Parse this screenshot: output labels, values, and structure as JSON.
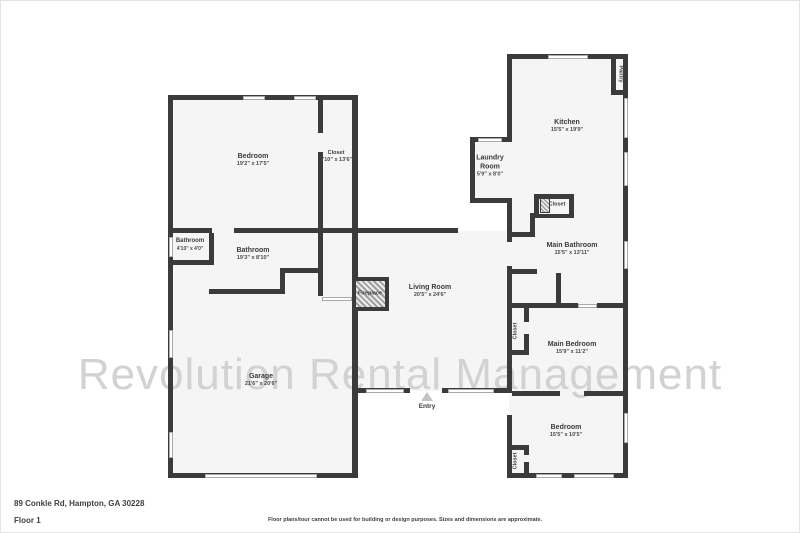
{
  "plan": {
    "watermark": "Revolution Rental Management",
    "entry_label": "Entry",
    "rooms": {
      "bedroom_1": {
        "name": "Bedroom",
        "dims": "19'2\" x 17'5\""
      },
      "closet_1": {
        "name": "Closet",
        "dims": "2'10\" x 13'6\""
      },
      "kitchen": {
        "name": "Kitchen",
        "dims": "15'5\" x 19'9\""
      },
      "pantry": {
        "name": "Pantry"
      },
      "laundry": {
        "name": "Laundry Room",
        "dims": "5'9\" x 8'0\""
      },
      "closet_kitchen": {
        "name": "Closet"
      },
      "bathroom_1": {
        "name": "Bathroom",
        "dims": "4'10\" x 4'0\""
      },
      "bathroom_2": {
        "name": "Bathroom",
        "dims": "19'3\" x 8'10\""
      },
      "main_bathroom": {
        "name": "Main Bathroom",
        "dims": "15'5\" x 13'11\""
      },
      "fireplace": {
        "name": "Fireplace"
      },
      "living_room": {
        "name": "Living Room",
        "dims": "20'5\" x 24'6\""
      },
      "closet_main_bed": {
        "name": "Closet"
      },
      "main_bedroom": {
        "name": "Main Bedroom",
        "dims": "15'9\" x 11'2\""
      },
      "garage": {
        "name": "Garage",
        "dims": "21'6\" x 20'6\""
      },
      "bedroom_2": {
        "name": "Bedroom",
        "dims": "15'5\" x 10'5\""
      },
      "closet_bedroom_2": {
        "name": "Closet"
      }
    }
  },
  "footer": {
    "address": "89 Conkle Rd, Hampton, GA 30228",
    "floor": "Floor 1",
    "disclaimer": "Floor plans/tour cannot be used for building or design purposes. Sizes and dimensions are approximate."
  },
  "colors": {
    "wall": "#3b3b3b",
    "floor_fill": "#f5f5f5",
    "watermark": "#d2d2d2",
    "text": "#3b3b3b"
  }
}
